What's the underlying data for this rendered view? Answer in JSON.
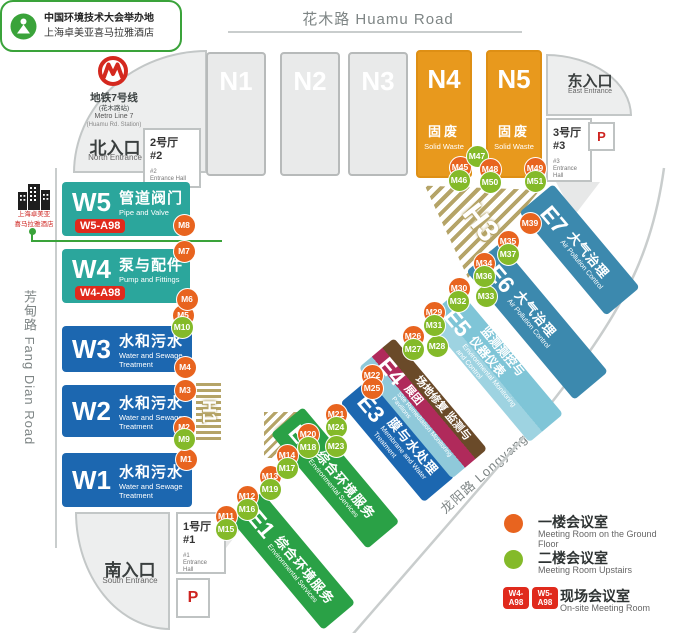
{
  "colors": {
    "orange_marker": "#E8641F",
    "green_marker": "#84BA29",
    "red_badge": "#E02A1C",
    "teal_hall": "#2BA69C",
    "blue_hall": "#1C67B0",
    "green_hall": "#2AA146",
    "light_blue_hall": "#7FC5D7",
    "steel_blue_hall": "#3C89AE",
    "orange_hall": "#E8991D",
    "maroon_stripe": "#B02A5B",
    "brown_stripe": "#6A4A29",
    "hatch_tan": "#B5A468"
  },
  "roads": {
    "huamu": "花木路 Huamu Road",
    "fangdian": "芳甸路 Fang Dian Road",
    "longyang": "龙阳路 Longyang Road"
  },
  "metro": {
    "line_zh": "地铁7号线",
    "station_zh": "(花木路站)",
    "line_en": "Metro Line 7",
    "station_en": "(Huamu Rd. Station)"
  },
  "entrances": {
    "north": {
      "zh": "北入口",
      "en": "North Entrance"
    },
    "east": {
      "zh": "东入口",
      "en": "East Entrance"
    },
    "south": {
      "zh": "南入口",
      "en": "South Entrance"
    }
  },
  "entrance_halls": {
    "hall1": {
      "zh": "1号厅",
      "num": "#1",
      "sub_num": "#1",
      "sub_en": "Entrance Hall"
    },
    "hall2": {
      "zh": "2号厅",
      "num": "#2",
      "sub_num": "#2",
      "sub_en": "Entrance Hall"
    },
    "hall3": {
      "zh": "3号厅",
      "num": "#3",
      "sub_num": "#3",
      "sub_en": "Entrance Hall"
    }
  },
  "parking_label": "P",
  "hotel": {
    "line1": "上海卓美亚",
    "line2": "喜马拉雅酒店"
  },
  "callout": {
    "title": "中国环境技术大会举办地",
    "subtitle": "上海卓美亚喜马拉雅酒店"
  },
  "halls": {
    "n1": {
      "code": "N1"
    },
    "n2": {
      "code": "N2"
    },
    "n3": {
      "code": "N3"
    },
    "n4": {
      "code": "N4",
      "zh": "固废",
      "en": "Solid Waste"
    },
    "n5": {
      "code": "N5",
      "zh": "固废",
      "en": "Solid Waste"
    },
    "w5": {
      "code": "W5",
      "zh": "管道阀门",
      "en": "Pipe and Valve",
      "badge": "W5-A98"
    },
    "w4": {
      "code": "W4",
      "zh": "泵与配件",
      "en": "Pump and Fittings",
      "badge": "W4-A98"
    },
    "w3": {
      "code": "W3",
      "zh": "水和污水",
      "en": "Water and Sewage Treatment"
    },
    "w2": {
      "code": "W2",
      "zh": "水和污水",
      "en": "Water and Sewage Treatment"
    },
    "w1": {
      "code": "W1",
      "zh": "水和污水",
      "en": "Water and Sewage Treatment"
    },
    "e1": {
      "code": "E1",
      "zh": "综合环境服务",
      "en": "Environmental Services"
    },
    "e2": {
      "code": "E2",
      "zh": "综合环境服务",
      "en": "Environmental Services"
    },
    "e3": {
      "code": "E3",
      "zh": "膜与水处理",
      "en": "Membrane and Water Treatment"
    },
    "e4": {
      "code": "E4",
      "zh": "场地修复 监测与展团",
      "en": "Site Remediation Monitoring Pavilions"
    },
    "e5": {
      "code": "E5",
      "zh": "监测测控与仪器仪表",
      "en": "Environmental Monitoring and Control"
    },
    "e6": {
      "code": "E6",
      "zh": "大气治理",
      "en": "Air Pollution Control"
    },
    "e7": {
      "code": "E7",
      "zh": "大气治理",
      "en": "Air Pollution Control"
    },
    "h1": {
      "code": "H1"
    },
    "h2": {
      "code": "H2"
    },
    "h3": {
      "code": "H3"
    }
  },
  "markers": [
    {
      "id": "M1",
      "x": 186,
      "y": 459,
      "color": "orange"
    },
    {
      "id": "M2",
      "x": 184,
      "y": 427,
      "color": "orange"
    },
    {
      "id": "M9",
      "x": 184,
      "y": 439,
      "color": "green"
    },
    {
      "id": "M3",
      "x": 185,
      "y": 390,
      "color": "orange"
    },
    {
      "id": "M4",
      "x": 185,
      "y": 367,
      "color": "orange"
    },
    {
      "id": "M5",
      "x": 183,
      "y": 315,
      "color": "orange"
    },
    {
      "id": "M10",
      "x": 182,
      "y": 327,
      "color": "green"
    },
    {
      "id": "M6",
      "x": 187,
      "y": 299,
      "color": "orange"
    },
    {
      "id": "M7",
      "x": 184,
      "y": 251,
      "color": "orange"
    },
    {
      "id": "M8",
      "x": 184,
      "y": 225,
      "color": "orange"
    },
    {
      "id": "M11",
      "x": 226,
      "y": 516,
      "color": "orange"
    },
    {
      "id": "M15",
      "x": 226,
      "y": 529,
      "color": "green"
    },
    {
      "id": "M12",
      "x": 247,
      "y": 496,
      "color": "orange"
    },
    {
      "id": "M16",
      "x": 247,
      "y": 509,
      "color": "green"
    },
    {
      "id": "M13",
      "x": 270,
      "y": 476,
      "color": "orange"
    },
    {
      "id": "M19",
      "x": 270,
      "y": 489,
      "color": "green"
    },
    {
      "id": "M14",
      "x": 287,
      "y": 455,
      "color": "orange"
    },
    {
      "id": "M17",
      "x": 287,
      "y": 468,
      "color": "green"
    },
    {
      "id": "M20",
      "x": 308,
      "y": 434,
      "color": "orange"
    },
    {
      "id": "M18",
      "x": 308,
      "y": 447,
      "color": "green"
    },
    {
      "id": "M21",
      "x": 336,
      "y": 414,
      "color": "orange"
    },
    {
      "id": "M24",
      "x": 336,
      "y": 427,
      "color": "green"
    },
    {
      "id": "M23",
      "x": 336,
      "y": 446,
      "color": "green"
    },
    {
      "id": "M22",
      "x": 372,
      "y": 375,
      "color": "orange"
    },
    {
      "id": "M25",
      "x": 372,
      "y": 388,
      "color": "orange"
    },
    {
      "id": "M26",
      "x": 413,
      "y": 336,
      "color": "orange"
    },
    {
      "id": "M27",
      "x": 413,
      "y": 349,
      "color": "green"
    },
    {
      "id": "M28",
      "x": 437,
      "y": 346,
      "color": "green"
    },
    {
      "id": "M29",
      "x": 434,
      "y": 312,
      "color": "orange"
    },
    {
      "id": "M31",
      "x": 434,
      "y": 325,
      "color": "green"
    },
    {
      "id": "M30",
      "x": 459,
      "y": 288,
      "color": "orange"
    },
    {
      "id": "M32",
      "x": 458,
      "y": 301,
      "color": "green"
    },
    {
      "id": "M33",
      "x": 486,
      "y": 296,
      "color": "green"
    },
    {
      "id": "M34",
      "x": 484,
      "y": 263,
      "color": "orange"
    },
    {
      "id": "M36",
      "x": 484,
      "y": 276,
      "color": "green"
    },
    {
      "id": "M35",
      "x": 508,
      "y": 241,
      "color": "orange"
    },
    {
      "id": "M37",
      "x": 508,
      "y": 254,
      "color": "green"
    },
    {
      "id": "M39",
      "x": 530,
      "y": 223,
      "color": "orange"
    },
    {
      "id": "M45",
      "x": 460,
      "y": 167,
      "color": "orange"
    },
    {
      "id": "M46",
      "x": 459,
      "y": 180,
      "color": "green"
    },
    {
      "id": "M47",
      "x": 477,
      "y": 156,
      "color": "green"
    },
    {
      "id": "M48",
      "x": 490,
      "y": 169,
      "color": "orange"
    },
    {
      "id": "M50",
      "x": 490,
      "y": 182,
      "color": "green"
    },
    {
      "id": "M49",
      "x": 535,
      "y": 168,
      "color": "orange"
    },
    {
      "id": "M51",
      "x": 535,
      "y": 181,
      "color": "green"
    }
  ],
  "legend": {
    "ground": {
      "zh": "一楼会议室",
      "en": "Meeting Room on the Ground Floor"
    },
    "upstairs": {
      "zh": "二楼会议室",
      "en": "Meeting Room Upstairs"
    },
    "onsite": {
      "zh": "现场会议室",
      "en": "On-site Meeting Room",
      "badges": [
        "W4-A98",
        "W5-A98"
      ]
    }
  }
}
